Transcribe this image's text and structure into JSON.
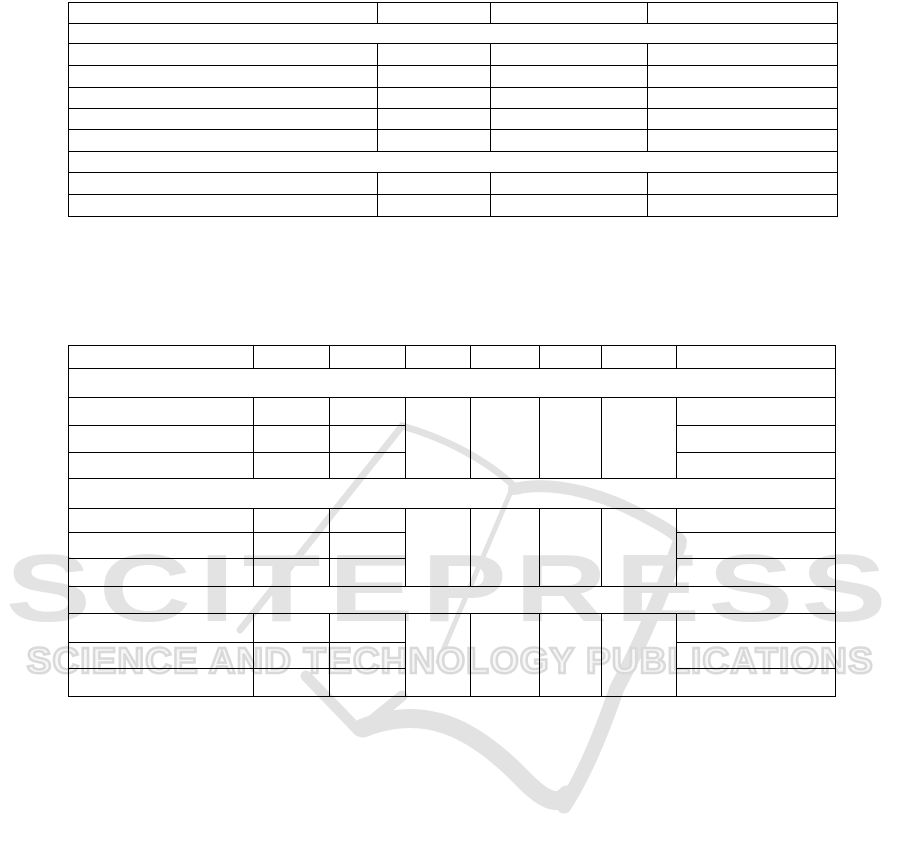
{
  "watermark": {
    "title": "SCITEPRESS",
    "subtitle": "SCIENCE AND TECHNOLOGY PUBLICATIONS",
    "title_color": "#e3e3e3",
    "subtitle_color": "#d9d9d9",
    "swoosh_color": "#e2e2e2"
  },
  "table1": {
    "columns": 4,
    "column_widths_px": [
      309,
      113,
      157,
      190
    ],
    "row_heights_px": [
      21,
      20,
      22,
      22,
      21,
      21,
      22,
      21,
      22,
      22
    ],
    "full_width_merged_rows": [
      2,
      8
    ],
    "border_color": "#000000"
  },
  "table2": {
    "columns": 8,
    "column_widths_px": [
      185,
      76,
      76,
      65,
      69,
      62,
      75,
      159
    ],
    "row_heights_px": [
      23,
      29,
      28,
      27,
      26,
      30,
      24,
      26,
      28,
      27,
      29,
      26,
      28
    ],
    "full_width_merged_rows": [
      2,
      6,
      10
    ],
    "row_blocks_with_vertical_merge": [
      [
        3,
        5
      ],
      [
        7,
        9
      ],
      [
        11,
        13
      ]
    ],
    "vertically_merged_columns_in_blocks": [
      4,
      5,
      6,
      7
    ],
    "border_color": "#000000"
  }
}
